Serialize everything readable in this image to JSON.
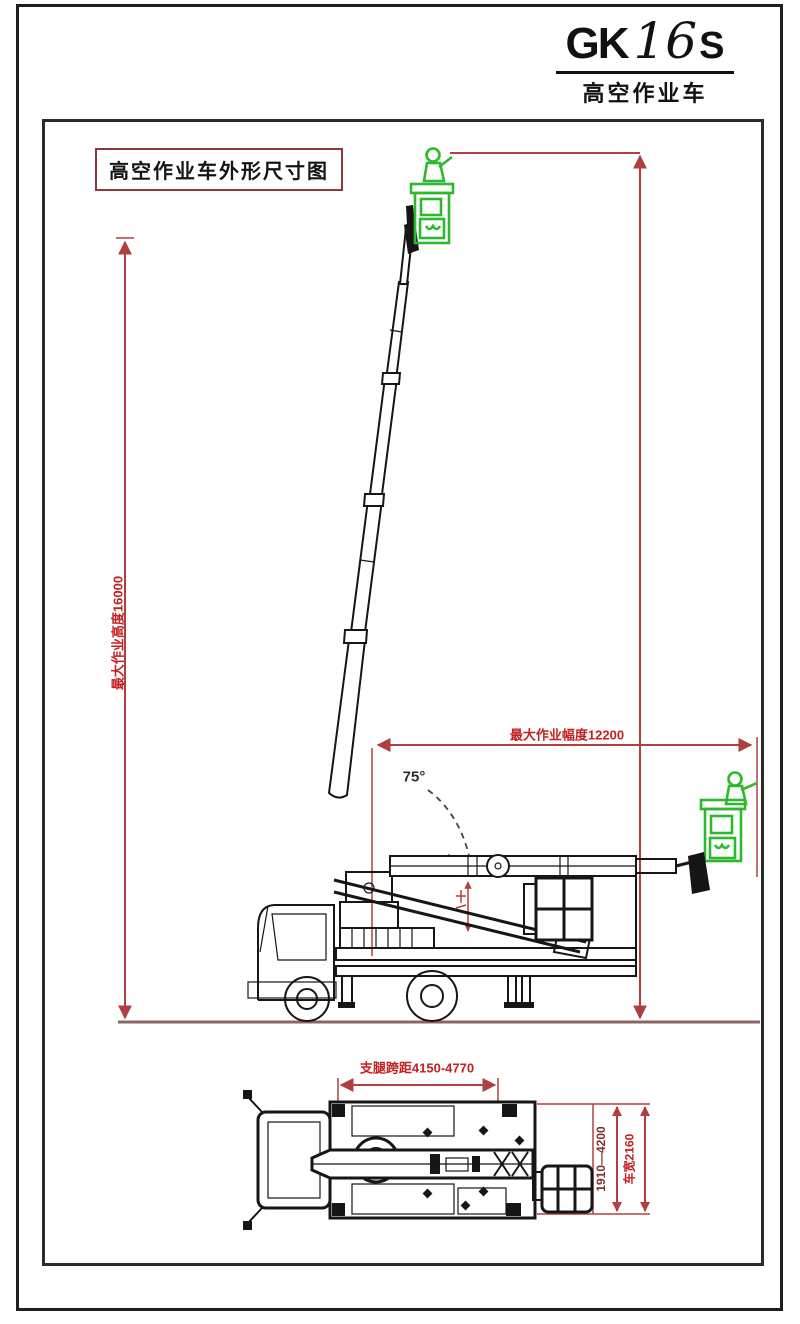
{
  "logo": {
    "series": "GK",
    "model_number": "16",
    "variant": "S",
    "subtitle": "高空作业车"
  },
  "drawing": {
    "title": "高空作业车外形尺寸图",
    "annotations": {
      "max_work_height": "最大作业高度16000",
      "max_work_radius": "最大作业幅度12200",
      "boom_angle": "75°",
      "outrigger_span": "支腿跨距4150-4770",
      "outrigger_lateral_span": "1910—4200",
      "vehicle_width": "车宽2160"
    },
    "colors": {
      "dimension_line": "#b04040",
      "dimension_text": "#c42020",
      "dimension_text_dark": "#7d3030",
      "accent_green": "#2db92d",
      "ink": "#161616",
      "ground_line": "#8d6464",
      "title_border": "#8a3a3a"
    }
  }
}
